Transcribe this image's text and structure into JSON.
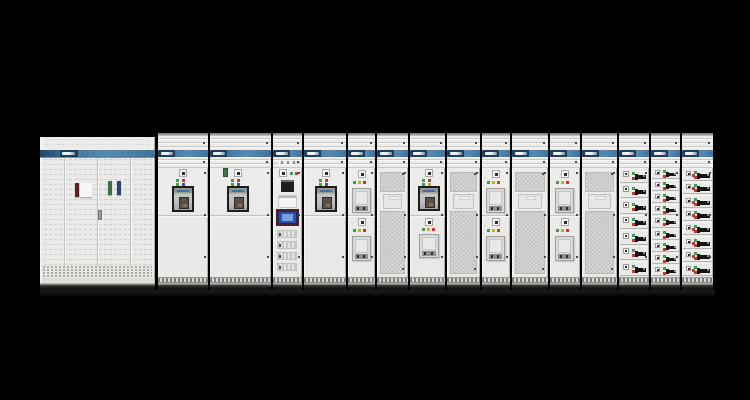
{
  "scene": {
    "width": 750,
    "height": 400,
    "background": "#000000"
  },
  "palette": {
    "panel_body": "#ebebe9",
    "stripe_blue": "#3f739d",
    "stripe_blue_dark": "#1f4a6b",
    "logo_navy": "#1c3f5e",
    "mesh_bg": "#d9d9d7",
    "led_green": "#3f9e52",
    "led_red": "#c33a32",
    "led_amber": "#d4a42a",
    "led_blue": "#33589f",
    "hmi_screen": "#2b50b8",
    "hmi_screen_light": "#7ba1d9",
    "device_black": "#1e1e1c",
    "plate_white": "#f4f4f2",
    "tag_maroon": "#5d2026",
    "tag_green": "#3f7049",
    "tag_navy": "#2c4372",
    "tag_label": "#f6f6f4",
    "handle_gray": "#9a9a96",
    "window_frame": "#1d1d1b",
    "base_dark": "#1c1c1a"
  },
  "left_cabinet": {
    "x": 40,
    "y": 137,
    "w": 115,
    "h": 153,
    "door_seams": [
      24,
      57,
      90
    ],
    "tags": [
      {
        "color": "tag_maroon",
        "x": 35,
        "y": 46,
        "w": 4,
        "h": 14
      },
      {
        "color": "tag_label",
        "x": 40,
        "y": 46,
        "w": 12,
        "h": 14
      },
      {
        "color": "tag_green",
        "x": 68,
        "y": 44,
        "w": 4,
        "h": 14
      },
      {
        "color": "tag_navy",
        "x": 77,
        "y": 44,
        "w": 4,
        "h": 14
      }
    ],
    "door_handle": {
      "x": 58,
      "y": 73,
      "w": 4,
      "h": 10
    }
  },
  "lineup": {
    "top": 133,
    "panels": [
      {
        "id": "breaker-section-1",
        "x": 158,
        "w": 50,
        "type": "acb"
      },
      {
        "id": "breaker-section-2",
        "x": 210,
        "w": 61,
        "type": "acb",
        "accessory": true
      },
      {
        "id": "control-section",
        "x": 273,
        "w": 29,
        "type": "control"
      },
      {
        "id": "breaker-section-3",
        "x": 304,
        "w": 42,
        "type": "acb"
      },
      {
        "id": "feeder-section-1",
        "x": 348,
        "w": 27,
        "type": "module2"
      },
      {
        "id": "vent-section-1",
        "x": 377,
        "w": 31,
        "type": "mesh",
        "window": true
      },
      {
        "id": "feeder-section-2",
        "x": 410,
        "w": 35,
        "type": "acb2"
      },
      {
        "id": "vent-section-2",
        "x": 447,
        "w": 33,
        "type": "mesh",
        "window": true
      },
      {
        "id": "feeder-section-3",
        "x": 482,
        "w": 28,
        "type": "module2"
      },
      {
        "id": "vent-section-3",
        "x": 512,
        "w": 36,
        "type": "mesh",
        "window": true
      },
      {
        "id": "feeder-section-4",
        "x": 550,
        "w": 30,
        "type": "module2"
      },
      {
        "id": "vent-section-4",
        "x": 582,
        "w": 35,
        "type": "mesh",
        "window": true
      },
      {
        "id": "mcc-section-1",
        "x": 619,
        "w": 30,
        "type": "drawers",
        "rows": 7,
        "style": "A"
      },
      {
        "id": "mcc-section-2",
        "x": 651,
        "w": 29,
        "type": "drawers",
        "rows": 9,
        "style": "B"
      },
      {
        "id": "mcc-section-3",
        "x": 682,
        "w": 31,
        "type": "drawers",
        "rows": 8,
        "style": "C"
      }
    ]
  }
}
